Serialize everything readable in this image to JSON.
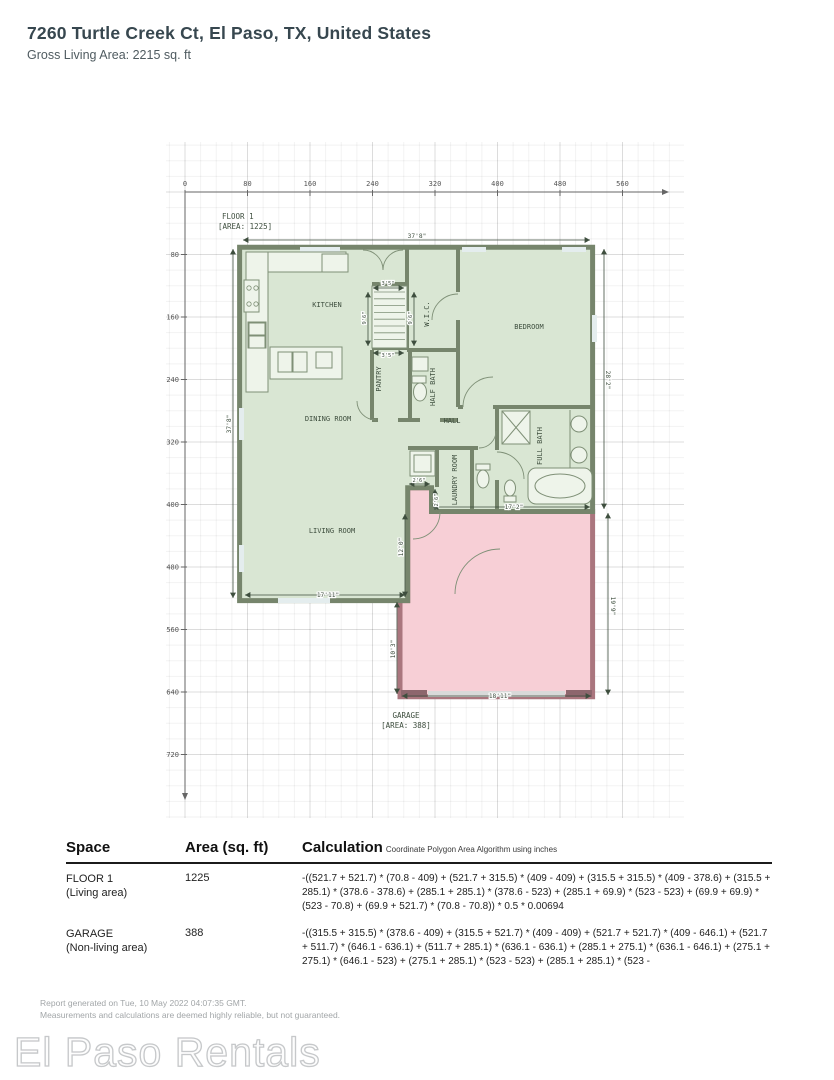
{
  "header": {
    "title": "7260 Turtle Creek Ct, El Paso, TX, United States",
    "subtitle": "Gross Living Area: 2215 sq. ft"
  },
  "plan": {
    "floor_label_line1": "FLOOR 1",
    "floor_label_line2": "[AREA: 1225]",
    "garage_label_line1": "GARAGE",
    "garage_label_line2": "[AREA: 388]",
    "ruler_x_ticks": [
      "0",
      "80",
      "160",
      "240",
      "320",
      "400",
      "480",
      "560"
    ],
    "ruler_y_ticks": [
      "80",
      "160",
      "240",
      "320",
      "400",
      "480",
      "560",
      "640",
      "720"
    ],
    "rooms": [
      {
        "label": "KITCHEN",
        "x": 327,
        "y": 307,
        "r": 0
      },
      {
        "label": "W.I.C.",
        "x": 429,
        "y": 314,
        "r": -90
      },
      {
        "label": "BEDROOM",
        "x": 529,
        "y": 329,
        "r": 0
      },
      {
        "label": "PANTRY",
        "x": 381,
        "y": 379,
        "r": -90
      },
      {
        "label": "HALF BATH",
        "x": 435,
        "y": 387,
        "r": -90
      },
      {
        "label": "DINING ROOM",
        "x": 328,
        "y": 421,
        "r": 0
      },
      {
        "label": "HALL",
        "x": 452,
        "y": 423,
        "r": 0
      },
      {
        "label": "FULL BATH",
        "x": 542,
        "y": 446,
        "r": -90
      },
      {
        "label": "LAUNDRY ROOM",
        "x": 457,
        "y": 480,
        "r": -90
      },
      {
        "label": "LIVING ROOM",
        "x": 332,
        "y": 533,
        "r": 0
      }
    ],
    "dims": [
      {
        "t": "37'8\"",
        "x": 417,
        "y": 238,
        "r": 0,
        "line": [
          243,
          240,
          590,
          240
        ],
        "s": 6.2
      },
      {
        "t": "37'8\"",
        "x": 231,
        "y": 424,
        "r": -90,
        "line": [
          233,
          249,
          233,
          598
        ],
        "s": 6.2
      },
      {
        "t": "28'2\"",
        "x": 606,
        "y": 380,
        "r": 90,
        "line": [
          604,
          249,
          604,
          509
        ],
        "s": 6.2
      },
      {
        "t": "19'9\"",
        "x": 611,
        "y": 606,
        "r": 90,
        "line": [
          608,
          513,
          608,
          695
        ],
        "s": 6.2
      },
      {
        "t": "18'11\"",
        "x": 500,
        "y": 698,
        "r": 0,
        "line": [
          402,
          696,
          591,
          696
        ],
        "s": 6.2
      },
      {
        "t": "17'11\"",
        "x": 328,
        "y": 597,
        "r": 0,
        "line": [
          245,
          595,
          405,
          595
        ],
        "s": 6.2
      },
      {
        "t": "10'3\"",
        "x": 395,
        "y": 649,
        "r": -90,
        "line": [
          397,
          602,
          397,
          694
        ],
        "s": 6.2
      },
      {
        "t": "17'2\"",
        "x": 514,
        "y": 509,
        "r": 0,
        "line": [
          433,
          507,
          590,
          507
        ],
        "s": 6.2
      },
      {
        "t": "12'0\"",
        "x": 403,
        "y": 547,
        "r": -90,
        "line": [
          405,
          514,
          405,
          597
        ],
        "s": 6.2
      },
      {
        "t": "2'6\"",
        "x": 419,
        "y": 482,
        "r": 0,
        "line": [
          409,
          484,
          430,
          484
        ],
        "s": 5.4
      },
      {
        "t": "2'6\"",
        "x": 438,
        "y": 500,
        "r": -90,
        "line": [
          435,
          489,
          435,
          510
        ],
        "s": 5.4
      },
      {
        "t": "3'5\"",
        "x": 388,
        "y": 285,
        "r": 0,
        "line": [
          373,
          288,
          404,
          288
        ],
        "s": 5.4
      },
      {
        "t": "3'5\"",
        "x": 388,
        "y": 357,
        "r": 0,
        "line": [
          373,
          353,
          404,
          353
        ],
        "s": 5.4
      },
      {
        "t": "9'6\"",
        "x": 366,
        "y": 318,
        "r": -90,
        "line": [
          368,
          292,
          368,
          346
        ],
        "s": 5.4
      },
      {
        "t": "9'6\"",
        "x": 412,
        "y": 318,
        "r": -90,
        "line": [
          414,
          292,
          414,
          346
        ],
        "s": 5.4
      }
    ],
    "colors": {
      "living_fill": "#d9e6d3",
      "living_wall": "#76856c",
      "garage_fill": "#f7cfd6",
      "garage_wall": "#aa767e",
      "window": "#e4edee",
      "garage_door": "#d9d9d9",
      "garage_block": "#8d666d",
      "fixture": "#7f9077",
      "text": "#3e4e3e",
      "ruler": "#666666"
    }
  },
  "table": {
    "headers": {
      "space": "Space",
      "area": "Area (sq. ft)",
      "calc": "Calculation",
      "calc_note": "Coordinate Polygon Area Algorithm using inches"
    },
    "rows": [
      {
        "space_line1": "FLOOR 1",
        "space_line2": "(Living area)",
        "area": "1225",
        "calc": "-((521.7 + 521.7) * (70.8 - 409) + (521.7 + 315.5) * (409 - 409) + (315.5 + 315.5) * (409 - 378.6) + (315.5 + 285.1) * (378.6 - 378.6) + (285.1 + 285.1) * (378.6 - 523) + (285.1 + 69.9) * (523 - 523) + (69.9 + 69.9) * (523 - 70.8) + (69.9 + 521.7) * (70.8 - 70.8)) * 0.5 * 0.00694"
      },
      {
        "space_line1": "GARAGE",
        "space_line2": "(Non-living area)",
        "area": "388",
        "calc": "-((315.5 + 315.5) * (378.6 - 409) + (315.5 + 521.7) * (409 - 409) + (521.7 + 521.7) * (409 - 646.1) + (521.7 + 511.7) * (646.1 - 636.1) + (511.7 + 285.1) * (636.1 - 636.1) + (285.1 + 275.1) * (636.1 - 646.1) + (275.1 + 275.1) * (646.1 - 523) + (275.1 + 285.1) * (523 - 523) + (285.1 + 285.1) * (523 -"
      }
    ]
  },
  "footer": {
    "line1": "Report generated on Tue, 10 May 2022 04:07:35 GMT.",
    "line2": "Measurements and calculations are deemed highly reliable, but not guaranteed.",
    "watermark": "El Paso Rentals"
  }
}
